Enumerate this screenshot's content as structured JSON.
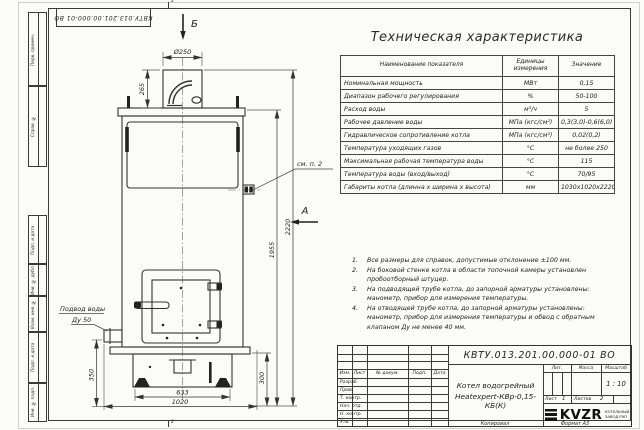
{
  "sheet": {
    "designation_top": "КВТУ.013.201.00.000-01 ВО",
    "zone_top": "2",
    "zone_bottom": "2",
    "copied_label": "Копировал",
    "format_label": "Формат А3"
  },
  "margin_boxes": {
    "perv": "Перв. примен.",
    "sprav": "Справ. №",
    "pd1": "Подп. и дата",
    "dubl": "Инв. № дубл.",
    "vzam": "Взам. инв. №",
    "pd2": "Подп. и дата",
    "podl": "Инв. № подл."
  },
  "tech_table": {
    "title": "Техническая характеристика",
    "col_name": "Наименование показателя",
    "col_units": "Единицы измерения",
    "col_value": "Значение",
    "rows": [
      {
        "name": "Номинальная мощность",
        "units": "МВт",
        "value": "0,15"
      },
      {
        "name": "Диапазон рабочего регулирования",
        "units": "%",
        "value": "50-100"
      },
      {
        "name": "Расход воды",
        "units": "м³/ч",
        "value": "5"
      },
      {
        "name": "Рабочее давление воды",
        "units": "МПа (кгс/см²)",
        "value": "0,3(3,0)-0,6(6,0)"
      },
      {
        "name": "Гидравлическое сопротивление котла",
        "units": "МПа (кгс/см²)",
        "value": "0,02(0,2)"
      },
      {
        "name": "Температура уходящих газов",
        "units": "°С",
        "value": "не более 250"
      },
      {
        "name": "Максимальная рабочая температура воды",
        "units": "°С",
        "value": "115"
      },
      {
        "name": "Температура воды (вход/выход)",
        "units": "°С",
        "value": "70/95"
      },
      {
        "name": "Габариты котла (длинна х ширина х высота)",
        "units": "мм",
        "value": "1030х1020х2220"
      }
    ]
  },
  "notes": {
    "items": [
      {
        "num": "1.",
        "lines": [
          "Все размеры для справок, допустимые отклонение ±100 мм."
        ]
      },
      {
        "num": "2.",
        "lines": [
          "На боковой стенке котла в области топочной камеры установлен",
          "пробоотборный штуцер."
        ]
      },
      {
        "num": "3.",
        "lines": [
          "На подводящей трубе котла, до запорной арматуры установлены:",
          "манометр, прибор для измерения температуры."
        ]
      },
      {
        "num": "4.",
        "lines": [
          "На отводящей трубе котла, до запорной арматуры установлены:",
          "манометр, прибор для измерения температуры и обвод с обратным",
          "клапаном Ду не менее 40 мм."
        ]
      }
    ]
  },
  "title_block": {
    "designation": "КВТУ.013.201.00.000-01 ВО",
    "head": {
      "izm": "Изм.",
      "list": "Лист",
      "dokum": "№ докум.",
      "podp": "Подп.",
      "data": "Дата"
    },
    "rows": [
      "Разраб.",
      "Пров.",
      "Т. контр.",
      "Нач. отд.",
      "Н. контр.",
      "Утв."
    ],
    "name_line1": "Котел водогрейный",
    "name_line2": "Heatexpert-КВр-0,15-КБ(К)",
    "lit_label": "Лит.",
    "massa_label": "Масса",
    "scale_label": "Масштаб",
    "scale": "1 : 10",
    "sheet_label": "Лист",
    "sheet_value": "1",
    "sheets_label": "Листов",
    "sheets_value": "2",
    "company": {
      "logo": "KVZR",
      "line1": "КОТЕЛЬНЫЙ",
      "line2": "ЗАВОД РЭП"
    }
  },
  "drawing": {
    "dims": {
      "d250": "Ø250",
      "h265": "265",
      "h2220": "2220",
      "h1955": "1955",
      "h350": "350",
      "h300": "300",
      "w633": "633",
      "w1020": "1020"
    },
    "labels": {
      "view_b": "Б",
      "view_a": "А",
      "see_note": "см. п. 2",
      "water1": "Подвод воды",
      "water2": "Ду 50"
    }
  }
}
